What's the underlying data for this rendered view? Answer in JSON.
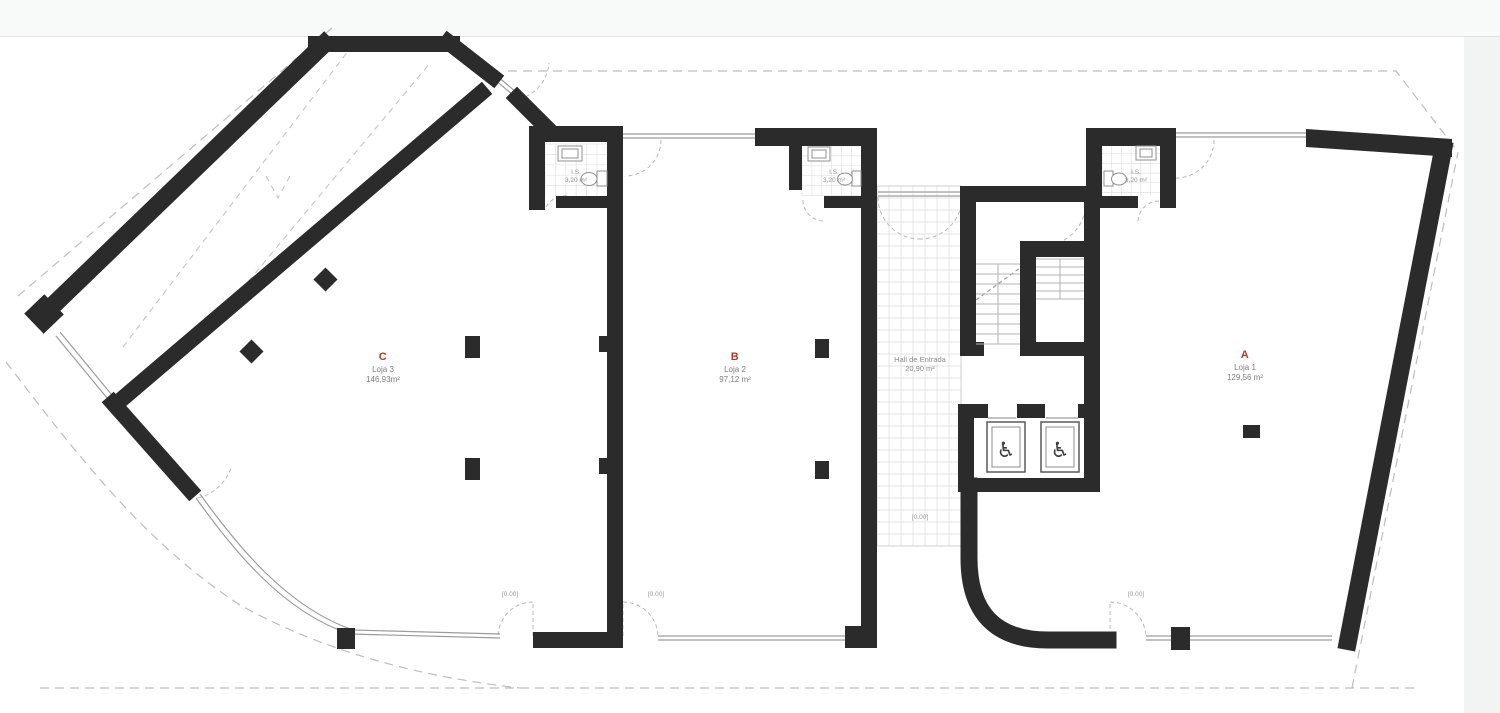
{
  "colors": {
    "wall": "#2b2b2b",
    "accent": "#b03a2e",
    "thin_line": "#9c9c9c",
    "dashed_line": "#bdbdbd",
    "tile_line": "#dcdcdc",
    "muted_text": "#8a8a8a"
  },
  "plan": {
    "units": [
      {
        "code": "A",
        "name": "Loja 1",
        "area": "129,56 m²"
      },
      {
        "code": "B",
        "name": "Loja 2",
        "area": "97,12 m²"
      },
      {
        "code": "C",
        "name": "Loja 3",
        "area": "146,93m²"
      }
    ],
    "hall": {
      "name": "Hall de Entrada",
      "area": "20,90 m²"
    },
    "bathrooms": [
      {
        "label": "I.S.",
        "area": "3,20 m²"
      },
      {
        "label": "I.S.",
        "area": "3,20 m²"
      },
      {
        "label": "I.S.",
        "area": "3,20 m²"
      }
    ],
    "level_markers": [
      "[0.00]",
      "[0.00]",
      "[0.00]",
      "[0.00]"
    ],
    "icons": {
      "wheelchair": "♿"
    }
  }
}
